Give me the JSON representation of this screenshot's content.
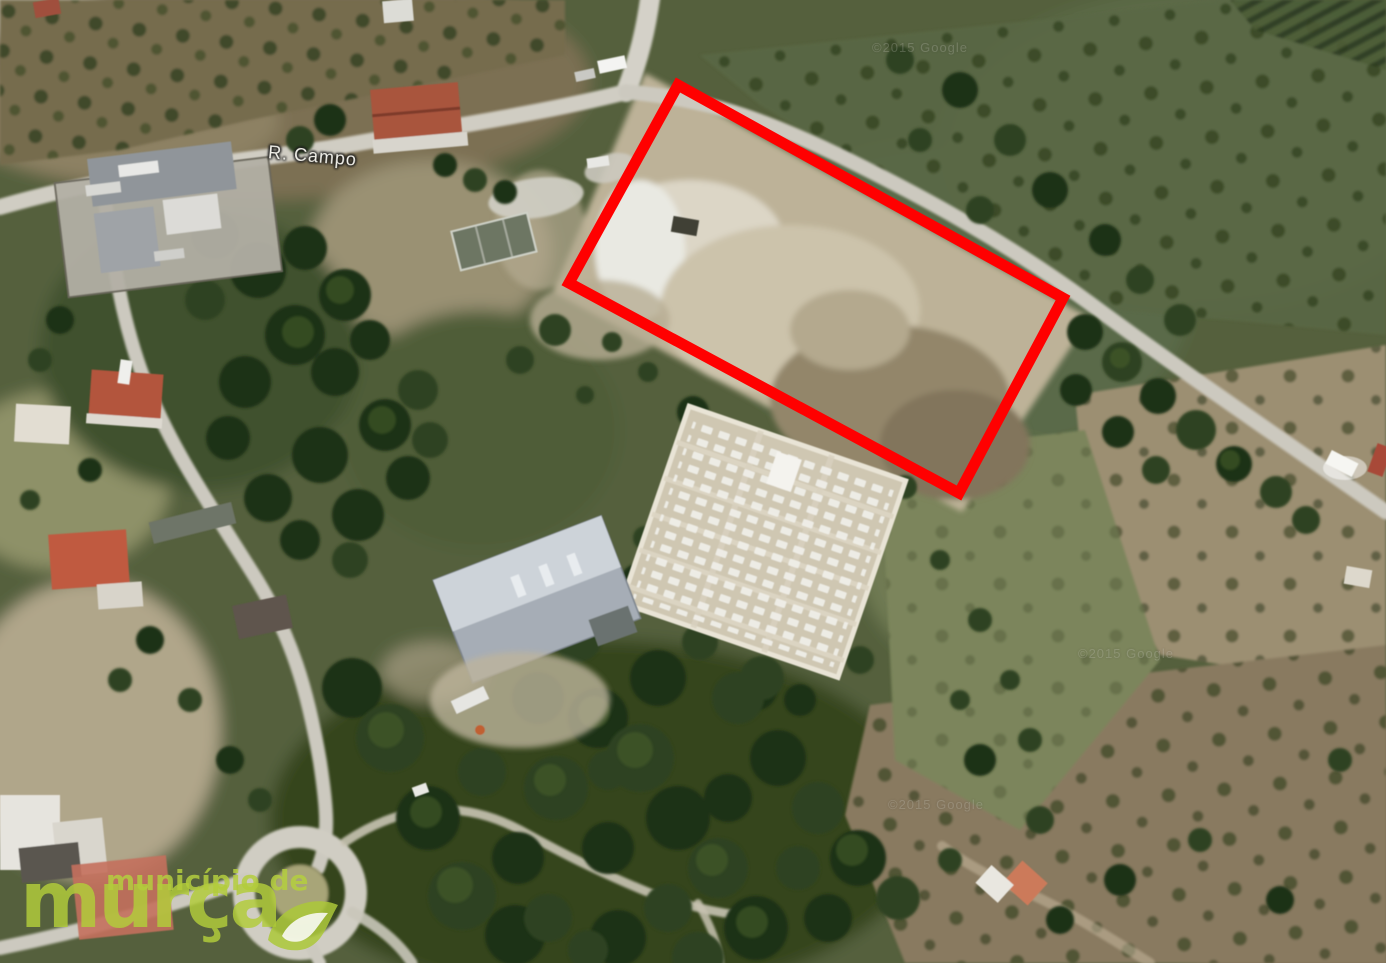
{
  "map": {
    "street_label": "R. Campo",
    "watermark_text": "©2015 Google",
    "annotation": {
      "shape": "rectangle",
      "color": "#ff0000",
      "meaning": "highlighted land parcel"
    },
    "logo": {
      "line1": "município de",
      "line2": "murça",
      "color": "#b4cc3e"
    }
  }
}
